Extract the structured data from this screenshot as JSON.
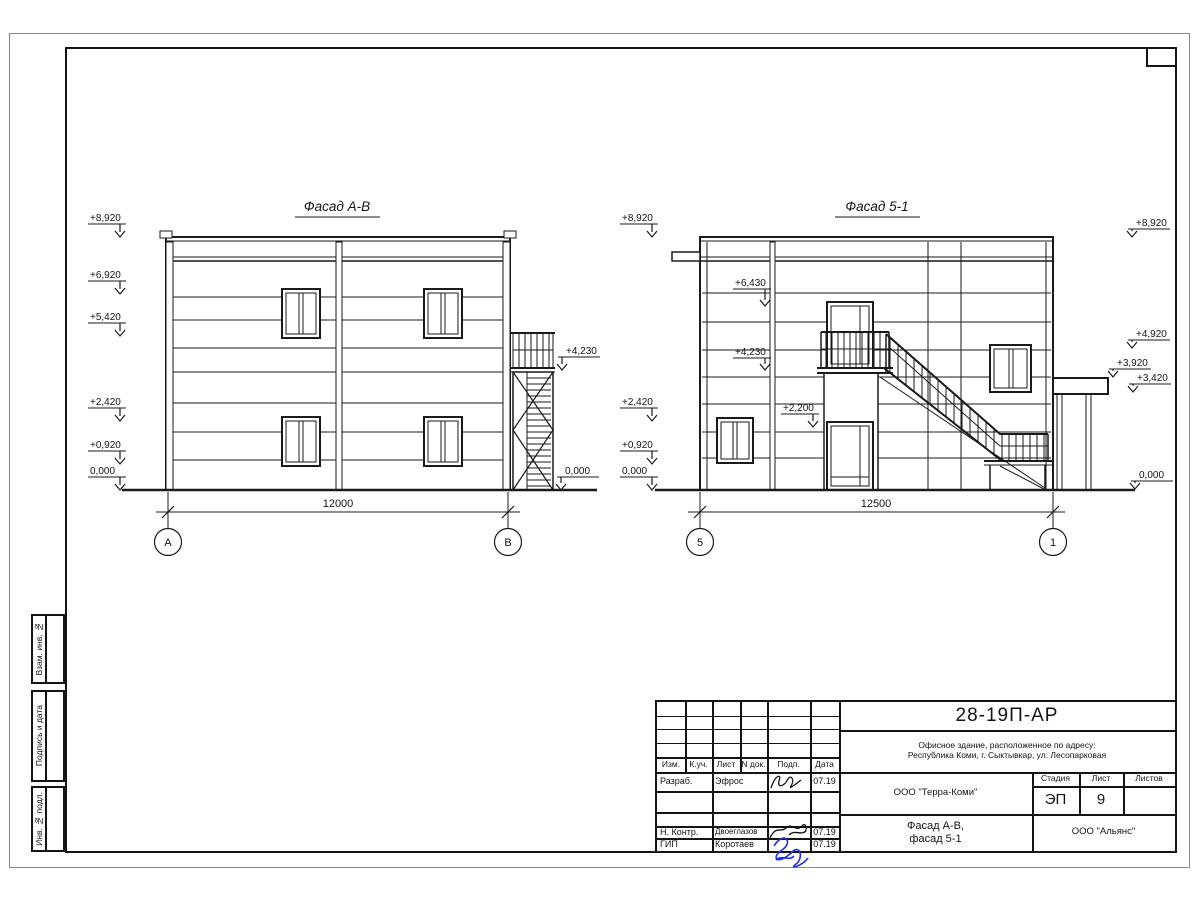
{
  "margin_labels": {
    "zam": "Взам. инв. №",
    "podpis": "Подпись и дата",
    "inv": "Инв. № подл."
  },
  "facade_ab": {
    "title": "Фасад А-В",
    "marks_left": [
      "+8,920",
      "+6,920",
      "+5,420",
      "+2,420",
      "+0,920",
      "0,000"
    ],
    "marks_right": [
      "+4,230",
      "0,000"
    ],
    "dimension": "12000",
    "axis_left": "А",
    "axis_right": "В"
  },
  "facade_51": {
    "title": "Фасад 5-1",
    "marks_left": [
      "+8,920",
      "+2,420",
      "+0,920",
      "0,000"
    ],
    "marks_inner": [
      "+6,430",
      "+4,230",
      "+2,200"
    ],
    "marks_right": [
      "+8,920",
      "+4,920",
      "+3,920",
      "+3,420",
      "0,000"
    ],
    "dimension": "12500",
    "axis_left": "5",
    "axis_right": "1"
  },
  "title_block": {
    "doc_number": "28-19П-АР",
    "address_line1": "Офисное здание, расположенное по адресу:",
    "address_line2": "Республика Коми, г. Сыктывкар, ул. Лесопарковая",
    "columns": {
      "izm": "Изм.",
      "kuch": "К.уч.",
      "list": "Лист",
      "ndok": "N док.",
      "podp": "Подп.",
      "data": "Дата"
    },
    "rows": {
      "razrab": {
        "role": "Разраб.",
        "name": "Эфрос",
        "date": "07.19"
      },
      "nkontr": {
        "role": "Н. Контр.",
        "name": "Двоеглазов",
        "date": "07.19"
      },
      "gip": {
        "role": "ГИП",
        "name": "Коротаев",
        "date": "07.19"
      }
    },
    "org1": "ООО \"Терра-Коми\"",
    "stage_label": "Стадия",
    "sheet_label": "Лист",
    "sheets_label": "Листов",
    "stage_value": "ЭП",
    "sheet_value": "9",
    "sheet_title_line1": "Фасад А-В,",
    "sheet_title_line2": "фасад 5-1",
    "org2": "ООО \"Альянс\""
  }
}
